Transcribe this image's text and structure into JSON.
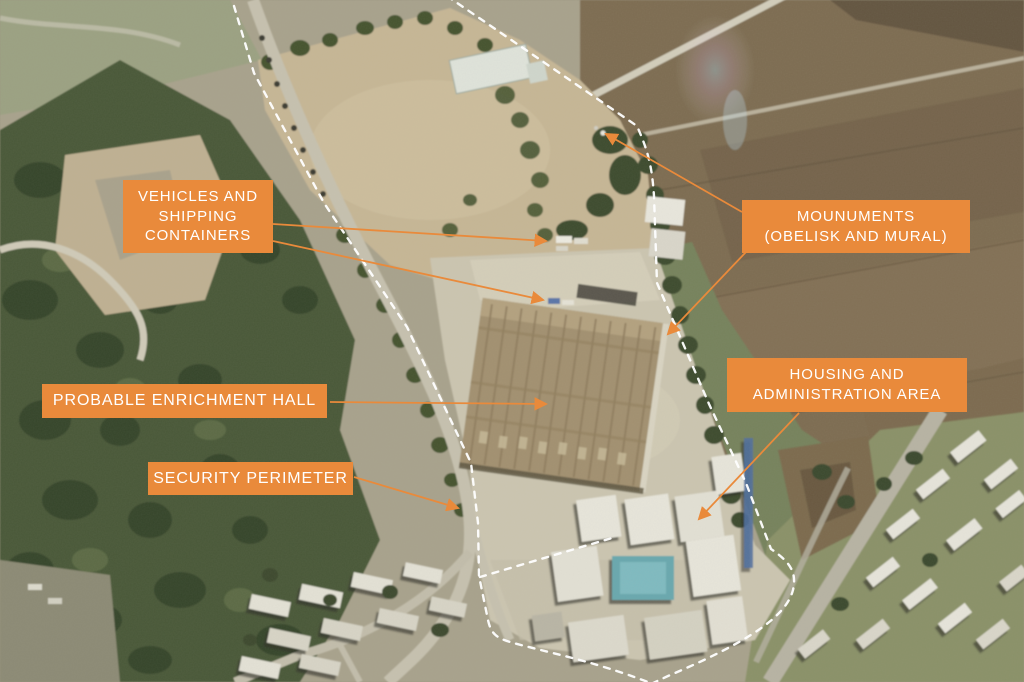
{
  "colors": {
    "accent_orange": "#E98A3B",
    "arrow_orange": "#F08A30",
    "perimeter_white": "#FFFFFF"
  },
  "labels": [
    {
      "id": "vehicles-and-shipping-containers",
      "lines": [
        "VEHICLES AND",
        "SHIPPING",
        "CONTAINERS"
      ]
    },
    {
      "id": "monuments-obelisk-and-mural",
      "lines": [
        "MOUNUMENTS",
        "(OBELISK AND MURAL)"
      ]
    },
    {
      "id": "probable-enrichment-hall",
      "lines": [
        "PROBABLE ENRICHMENT HALL"
      ]
    },
    {
      "id": "housing-and-administration-area",
      "lines": [
        "HOUSING AND",
        "ADMINISTRATION AREA"
      ]
    },
    {
      "id": "security-perimeter",
      "lines": [
        "SECURITY PERIMETER"
      ]
    }
  ]
}
